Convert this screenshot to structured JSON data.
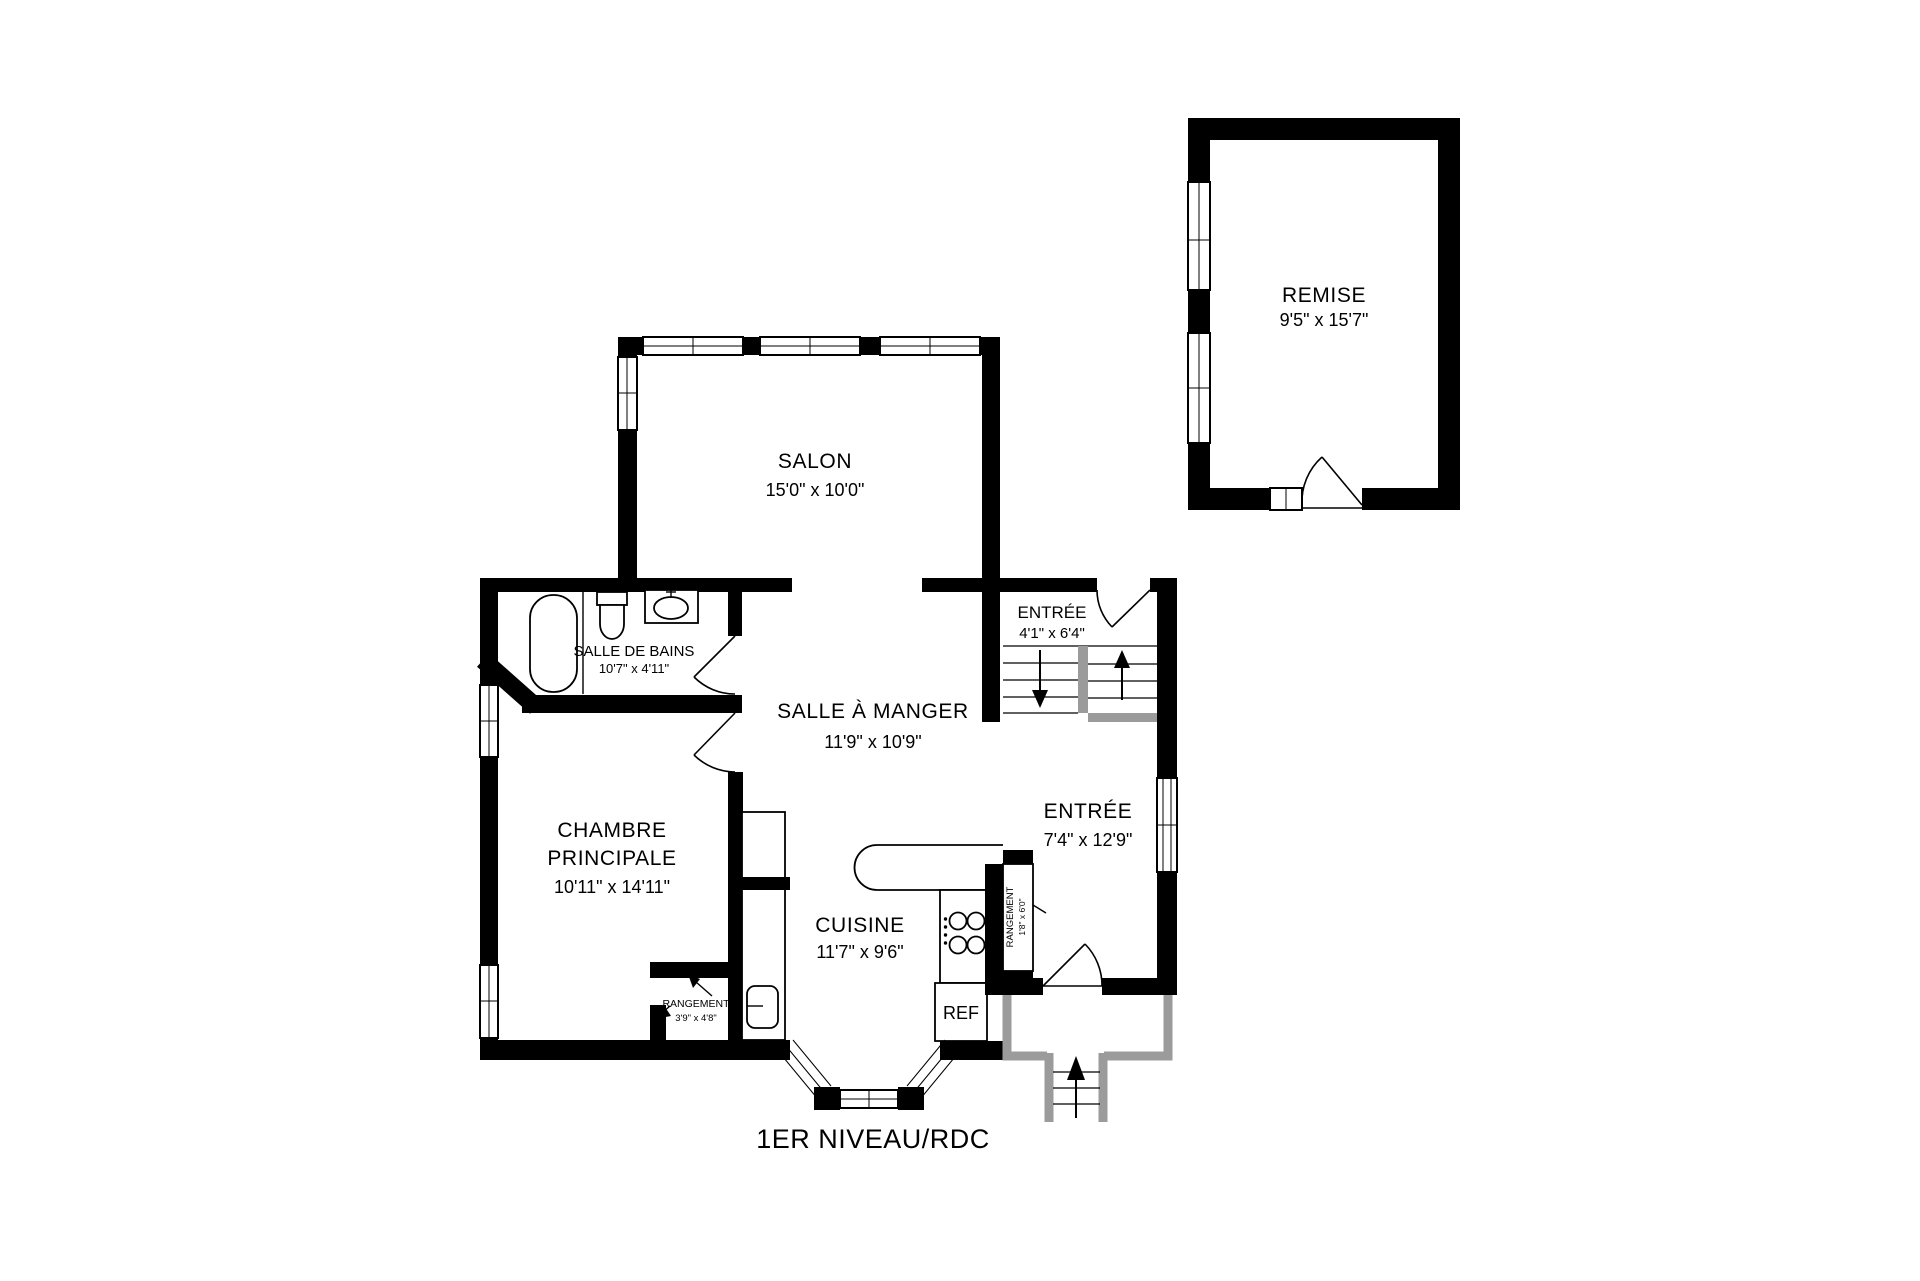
{
  "title": "1ER NIVEAU/RDC",
  "rooms": {
    "remise": {
      "name": "REMISE",
      "dims": "9'5\" x 15'7\""
    },
    "salon": {
      "name": "SALON",
      "dims": "15'0\" x 10'0\""
    },
    "salle_de_bains": {
      "name": "SALLE DE BAINS",
      "dims": "10'7\" x 4'11\""
    },
    "salle_a_manger": {
      "name": "SALLE À MANGER",
      "dims": "11'9\" x 10'9\""
    },
    "entree_haut": {
      "name": "ENTRÉE",
      "dims": "4'1\" x 6'4\""
    },
    "entree_bas": {
      "name": "ENTRÉE",
      "dims": "7'4\" x 12'9\""
    },
    "chambre": {
      "name_line1": "CHAMBRE",
      "name_line2": "PRINCIPALE",
      "dims": "10'11\" x 14'11\""
    },
    "cuisine": {
      "name": "CUISINE",
      "dims": "11'7\" x 9'6\""
    },
    "rangement_chambre": {
      "name": "RANGEMENT",
      "dims": "3'9\" x 4'8\""
    },
    "rangement_entree": {
      "name": "RANGEMENT",
      "dims": "1'8\" x 6'0\""
    }
  },
  "appliances": {
    "fridge_label": "REF"
  },
  "colors": {
    "wall": "#000000",
    "accent_gray": "#9b9b9b",
    "background": "#ffffff"
  }
}
